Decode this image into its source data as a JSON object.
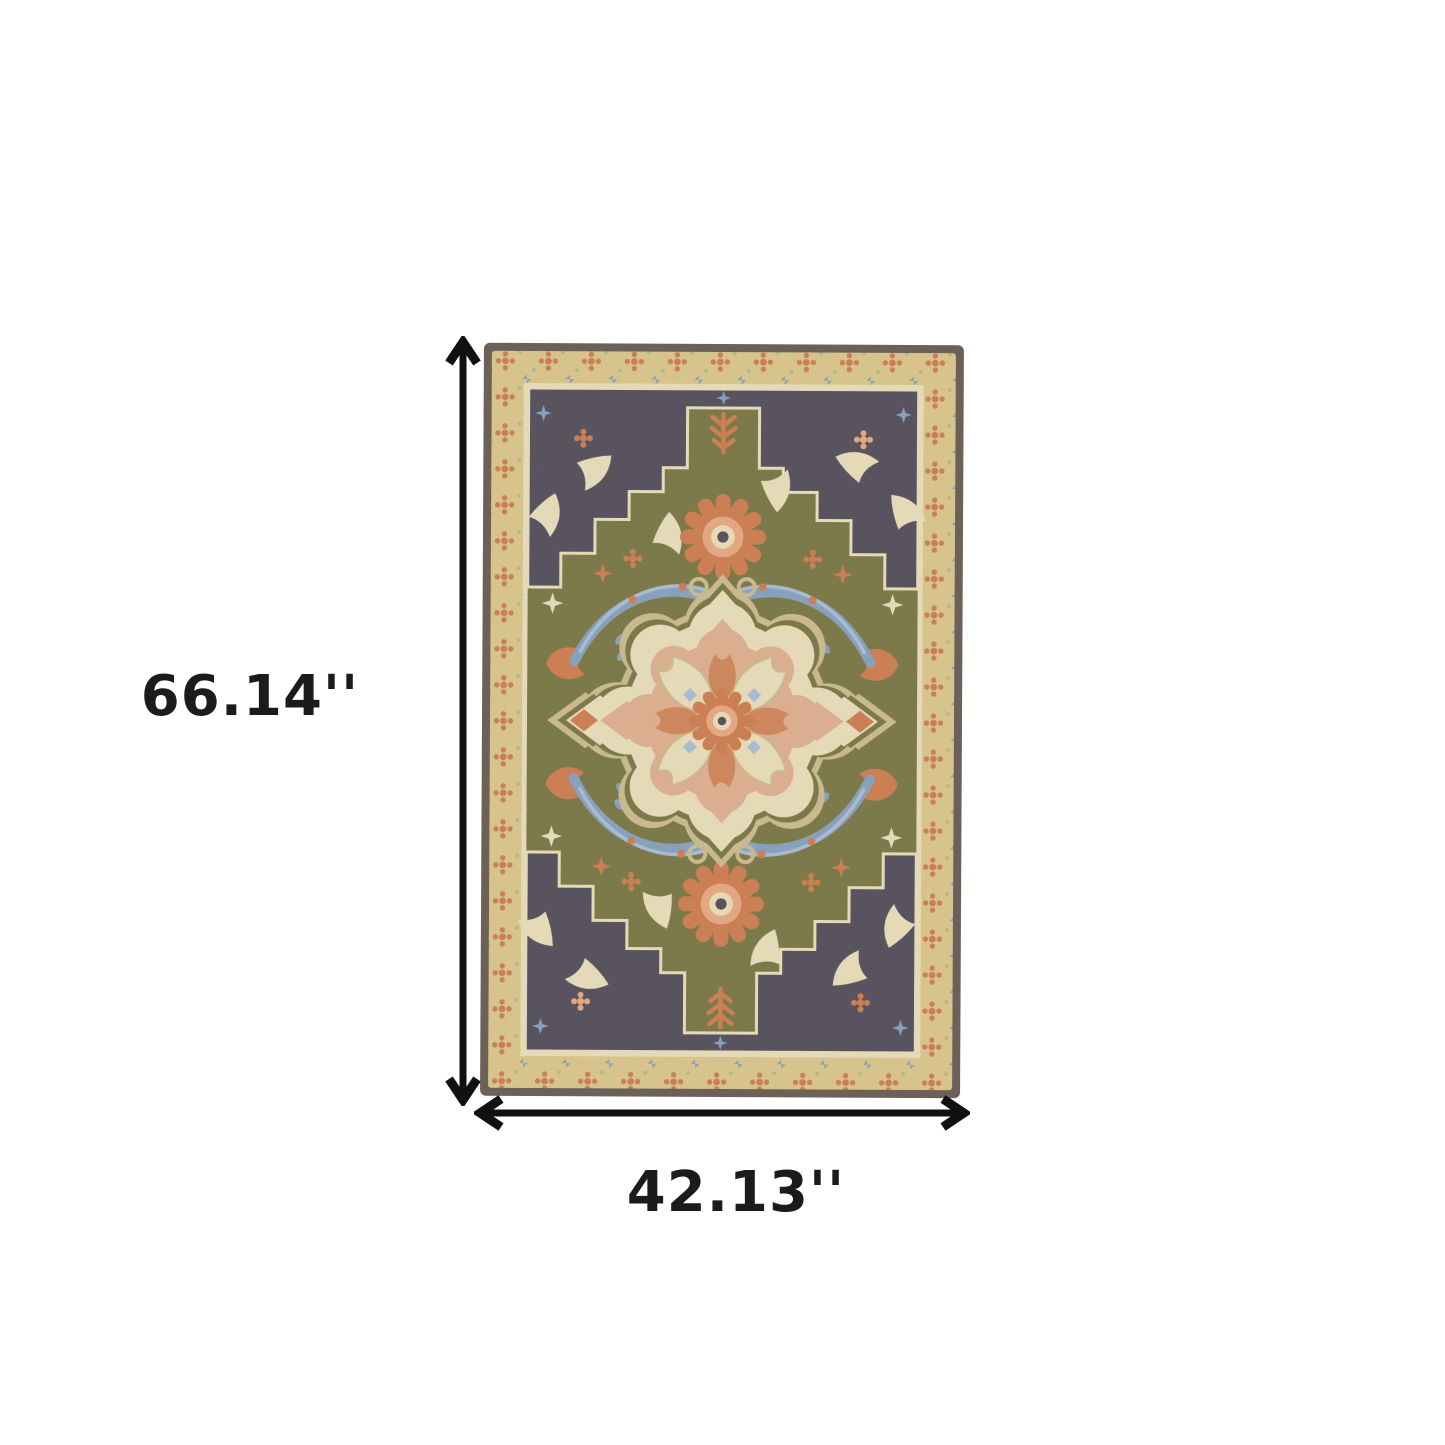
{
  "figure": {
    "type": "product-dimension-diagram",
    "product": {
      "kind": "area rug",
      "style": "traditional oriental medallion rug, hand-tufted wool texture",
      "visible_palette_summary": "olive green field, charcoal stepped spandrels, tan floral border, cream scalloped medallion, coral and slate-blue floral accents"
    },
    "dimensions": {
      "height_label": "66.14''",
      "width_label": "42.13''"
    }
  },
  "colors": {
    "background": "#ffffff",
    "arrow": "#111111",
    "label_text": "#1b1b1b",
    "rug_edge": "#6e635a",
    "rug_band": "#dcc88e",
    "rug_charcoal": "#5a5561",
    "rug_field": "#7e7c4b",
    "rug_sage": "#b7bb90",
    "rug_cream": "#eadfbc",
    "rug_cream_dark": "#cdbd92",
    "rug_blue": "#8ba4c0",
    "rug_blue_light": "#adbfd3",
    "rug_coral": "#d08256",
    "rug_peach": "#e8ab85",
    "rug_peach_light": "#dfb293"
  }
}
